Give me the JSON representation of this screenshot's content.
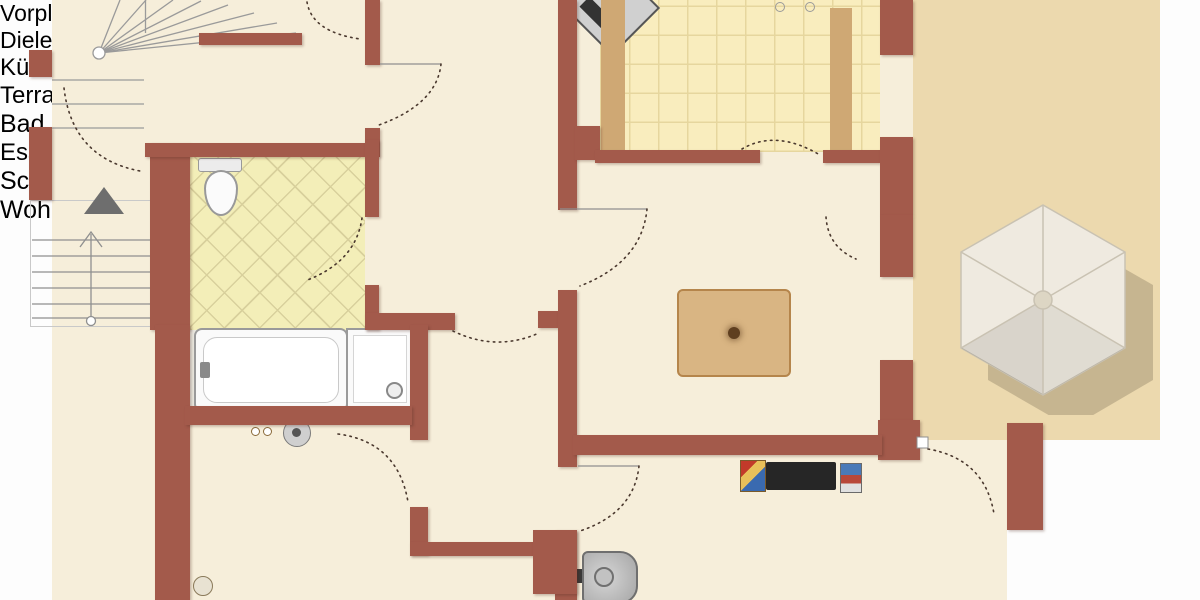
{
  "meta": {
    "type": "floor-plan",
    "language": "de"
  },
  "rooms": {
    "vorplatz": {
      "label": "Vorplatz"
    },
    "diele": {
      "label": "Diele"
    },
    "kueche": {
      "label": "Küche"
    },
    "terrasse": {
      "label": "Terrasse"
    },
    "bad": {
      "label": "Bad"
    },
    "esszimmer": {
      "label": "Esszimmer"
    },
    "schlafzimmer": {
      "label": "Schlafzimmer"
    },
    "wohnzimmer": {
      "label": "Wohnzimmer"
    }
  },
  "colors": {
    "wall": "#a35a4b",
    "floor_interior": "#f6eeda",
    "bathroom_tile": "#f3eeb8",
    "kitchen_tile": "#f9edbe",
    "terrace_tile": "#ecd9ae",
    "deck_wood": "#d6a96c",
    "paving": "#c6c6c6",
    "window_glass": "#a9c6d8",
    "furniture_wood_light": "#d3ab77",
    "furniture_wood_dark": "#7d4b27",
    "chair_terracotta": "#b45c36",
    "umbrella": "#efeae0",
    "label_text": "#1d1d1d"
  }
}
